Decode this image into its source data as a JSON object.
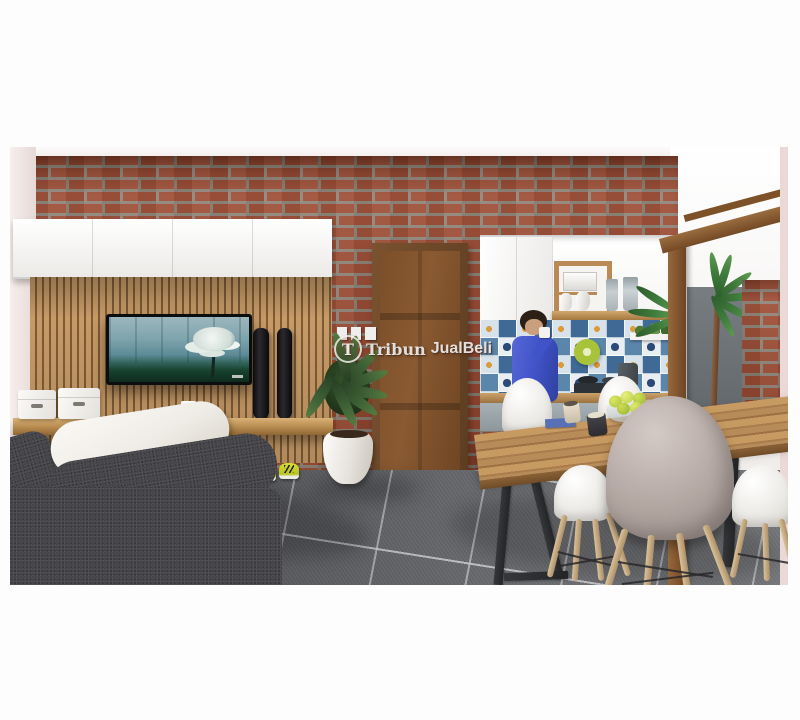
{
  "meta": {
    "kind": "photograph-like 3D interior render (real-estate listing image)",
    "scene": "modern living room with brick wall, slatted TV panel, wooden door, kitchen with patterned tile backsplash, dining table with eames-style chairs, woman drinking coffee",
    "canvas": {
      "width": 800,
      "height": 720
    }
  },
  "watermark": {
    "logo_letter": "T",
    "text_serif": "Tribun",
    "text_sans": "JualBeli",
    "full_text": "TribunJualBeli"
  },
  "palette": {
    "brick": "#9c4a31",
    "mortar": "#8e8276",
    "slat": "#c79a66",
    "slatgap": "#7c5b37",
    "counterwood": "#b98a56",
    "door": "#8a5a32",
    "floor": "#64666a",
    "sofa": "#454549",
    "cushion": "#efece6",
    "taupe": "#b3a7a2",
    "womantop": "#4053c8",
    "womanpants": "#3646a5",
    "skin": "#c99f7c",
    "palmgreen": "#3f7b3c",
    "shoeyellow": "#d6de2e",
    "lime": "#a8c23a",
    "tilesblue": "#3f6a96",
    "tilesnavy": "#2b4a78",
    "tileswhite": "#e9eef2",
    "tilesorange": "#d99b3c",
    "wallpink": "#f2e9e7",
    "leftpink": "#ead9d7"
  },
  "objects": [
    "brick-accent-wall",
    "white-upper-cabinets",
    "wood-slat-tv-panel",
    "flat-screen-tv",
    "tower-speakers",
    "floating-shelf",
    "storage-boxes",
    "coffee-cup",
    "potted-plant",
    "wooden-door",
    "light-switches",
    "kitchen-upper-cabinet",
    "open-shelf-microwave",
    "blender-jars",
    "ceramic-vases",
    "patterned-tile-backsplash",
    "green-colander",
    "herb-shelf",
    "kettle",
    "stove",
    "woman-drinking-coffee",
    "dining-table",
    "mugs",
    "fruit-bowl-green-apples",
    "white-eames-chairs",
    "taupe-eames-chair",
    "gray-sofa",
    "white-back-cushion",
    "throw-pillows",
    "yellow-sneakers",
    "dark-gray-tile-floor",
    "wood-pergola-beam",
    "wood-post",
    "outdoor-gray-wall",
    "outdoor-palm-tree",
    "outdoor-brick-pillar"
  ]
}
